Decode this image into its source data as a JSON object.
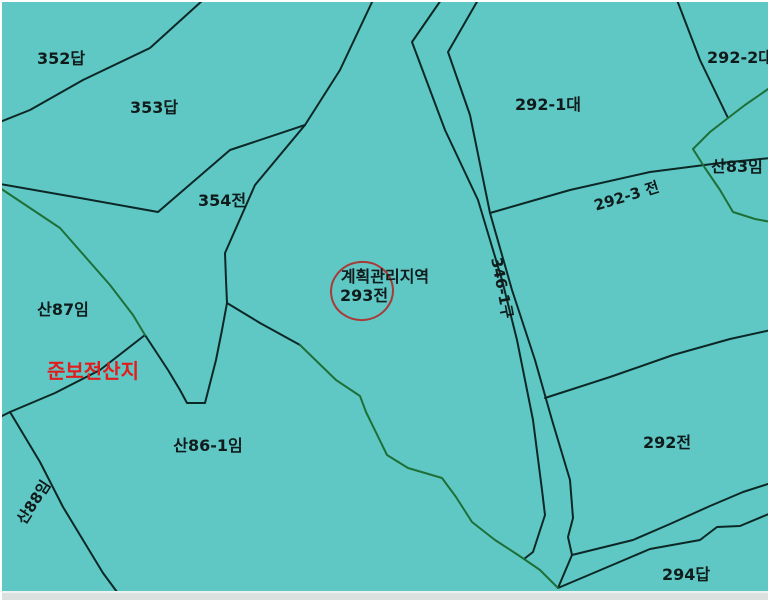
{
  "map": {
    "type": "cadastral-parcel-map",
    "colors": {
      "background": "#5fc8c4",
      "parcel_line": "#0c2826",
      "green_line": "#1e7038",
      "label_text": "#101c1c",
      "zone_text_red": "#e21d1d",
      "highlight_circle": "#a83a38",
      "bottom_bar": "#dce1df",
      "edge_border": "#ffffff"
    },
    "highlight": {
      "target_parcel": "293전",
      "shape": "ellipse"
    },
    "labels": [
      {
        "name": "parcel-label-352-dap",
        "kind": "parcel",
        "text": "352답",
        "x": 61,
        "y": 64,
        "rot": 0
      },
      {
        "name": "parcel-label-353-dap",
        "kind": "parcel",
        "text": "353답",
        "x": 154,
        "y": 113,
        "rot": 0
      },
      {
        "name": "parcel-label-354-jeon",
        "kind": "parcel",
        "text": "354전",
        "x": 222,
        "y": 206,
        "rot": 0
      },
      {
        "name": "parcel-label-292-1-dae",
        "kind": "parcel",
        "text": "292-1대",
        "x": 548,
        "y": 110,
        "rot": 0
      },
      {
        "name": "parcel-label-292-2-dae",
        "kind": "parcel",
        "text": "292-2대",
        "x": 740,
        "y": 63,
        "rot": 0
      },
      {
        "name": "parcel-label-san83-im",
        "kind": "parcel",
        "text": "산83임",
        "x": 737,
        "y": 172,
        "rot": 0
      },
      {
        "name": "parcel-label-292-3-jeon",
        "kind": "parcel-rot",
        "text": "292-3 전",
        "x": 628,
        "y": 201,
        "rot": -17
      },
      {
        "name": "road-label-346-1-gu",
        "kind": "road",
        "text": "346-1구",
        "x": 497,
        "y": 289,
        "rot": 79
      },
      {
        "name": "zone-label-plan-management",
        "kind": "zone",
        "text": "계획관리지역",
        "x": 385,
        "y": 282,
        "rot": 0
      },
      {
        "name": "parcel-label-293-jeon",
        "kind": "parcel",
        "text": "293전",
        "x": 364,
        "y": 301,
        "rot": 0
      },
      {
        "name": "parcel-label-san87-im",
        "kind": "parcel",
        "text": "산87임",
        "x": 63,
        "y": 315,
        "rot": 0
      },
      {
        "name": "zone-label-semi-preserved-forest",
        "kind": "zone-red",
        "text": "준보전산지",
        "x": 93,
        "y": 378,
        "rot": 0
      },
      {
        "name": "parcel-label-san86-1-im",
        "kind": "parcel",
        "text": "산86-1임",
        "x": 208,
        "y": 451,
        "rot": 0
      },
      {
        "name": "parcel-label-san88-im",
        "kind": "parcel-rot",
        "text": "산88임",
        "x": 38,
        "y": 505,
        "rot": -57
      },
      {
        "name": "parcel-label-292-jeon",
        "kind": "parcel",
        "text": "292전",
        "x": 667,
        "y": 448,
        "rot": 0
      },
      {
        "name": "parcel-label-294-dap",
        "kind": "parcel",
        "text": "294답",
        "x": 686,
        "y": 580,
        "rot": 0
      }
    ]
  }
}
